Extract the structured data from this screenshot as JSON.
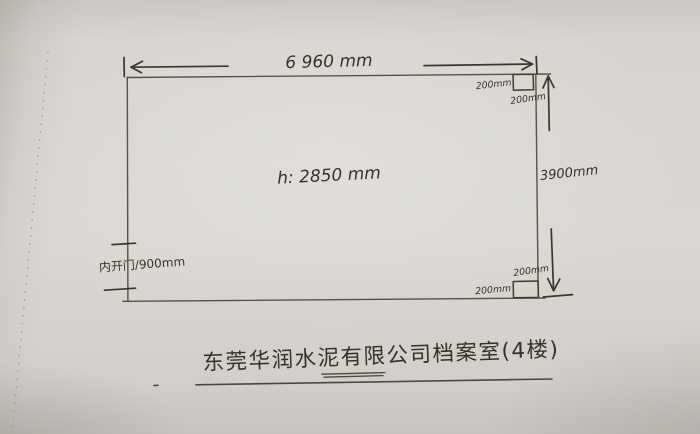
{
  "labels": {
    "top_width": "6 960 mm",
    "ceiling_height": "h: 2850 mm",
    "right_height": "3900mm",
    "door": "内开门/900mm",
    "top_right_column_width": "200mm",
    "top_right_column_depth": "200mm",
    "bottom_right_column_depth": "200mm",
    "bottom_right_column_width": "200mm",
    "caption": "东莞华润水泥有限公司档案室(4楼)"
  },
  "colors": {
    "paper": "#d8d5d0",
    "ink": "#3a372f",
    "wall_line": "#55524a"
  }
}
